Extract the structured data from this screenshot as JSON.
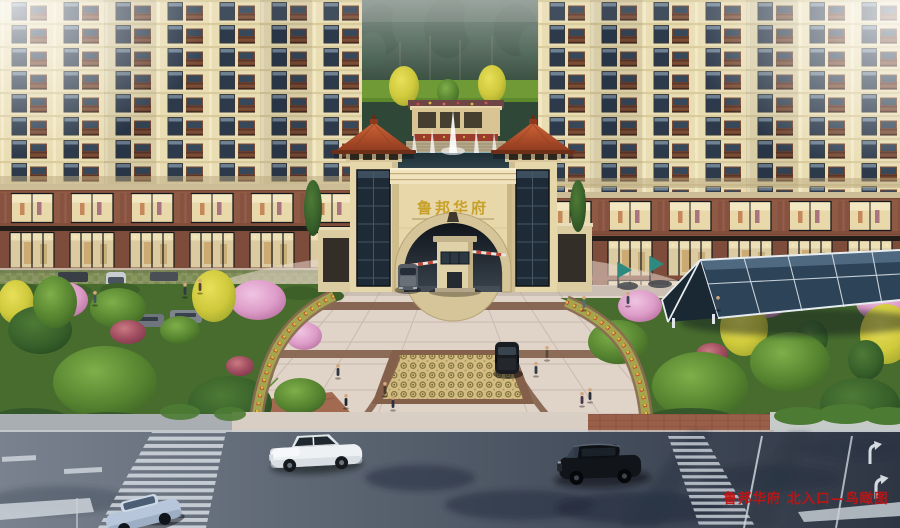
{
  "meta": {
    "kind": "architectural-rendering-aerial-view"
  },
  "gate": {
    "sign_text": "鲁邦华府"
  },
  "caption": {
    "text": "鲁邦华府 北入口—鸟瞰图",
    "color": "#c51212"
  },
  "palette": {
    "facade_cream": "#e9ddb4",
    "brick_brown": "#8f5a44",
    "roof_terracotta": "#b5502e",
    "sign_gold": "#c8a12b",
    "foliage_green": "#4f7c2e",
    "blossom_pink": "#dfa0cc",
    "ginkgo_yellow": "#d0ca3c",
    "plaza_paving": "#d8ccc2",
    "paving_band_brown": "#7d5a47",
    "asphalt_dark": "#3a4250",
    "crosswalk_white": "#ccd3da",
    "canopy_glass": "#2c4358",
    "pool_water": "#26383e"
  }
}
